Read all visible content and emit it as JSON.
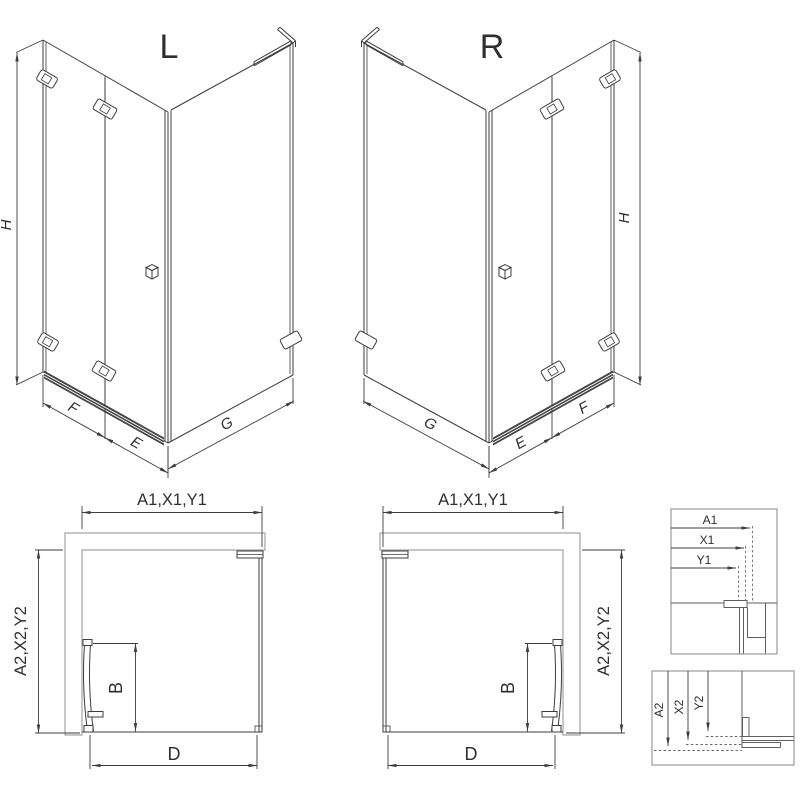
{
  "drawing_title": "Corner shower enclosure dimension drawing",
  "colors": {
    "line": "#3d3d3d",
    "wall_outline": "#a3a3a3",
    "profile": "#5f5f5f",
    "background": "#ffffff"
  },
  "views": {
    "iso_left": {
      "label": "L",
      "dim_height": "H",
      "dim_front_fixed": "F",
      "dim_front_door": "E",
      "dim_side": "G"
    },
    "iso_right": {
      "label": "R",
      "dim_height": "H",
      "dim_front_fixed": "F",
      "dim_front_door": "E",
      "dim_side": "G"
    },
    "plan_left": {
      "dim_top": "A1,X1,Y1",
      "dim_side": "A2,X2,Y2",
      "dim_door": "B",
      "dim_bottom": "D"
    },
    "plan_right": {
      "dim_top": "A1,X1,Y1",
      "dim_side": "A2,X2,Y2",
      "dim_door": "B",
      "dim_bottom": "D"
    },
    "detail_top": {
      "rows": [
        {
          "label": "A1"
        },
        {
          "label": "X1"
        },
        {
          "label": "Y1"
        }
      ]
    },
    "detail_bottom": {
      "rows": [
        {
          "label": "A2"
        },
        {
          "label": "X2"
        },
        {
          "label": "Y2"
        }
      ]
    }
  }
}
